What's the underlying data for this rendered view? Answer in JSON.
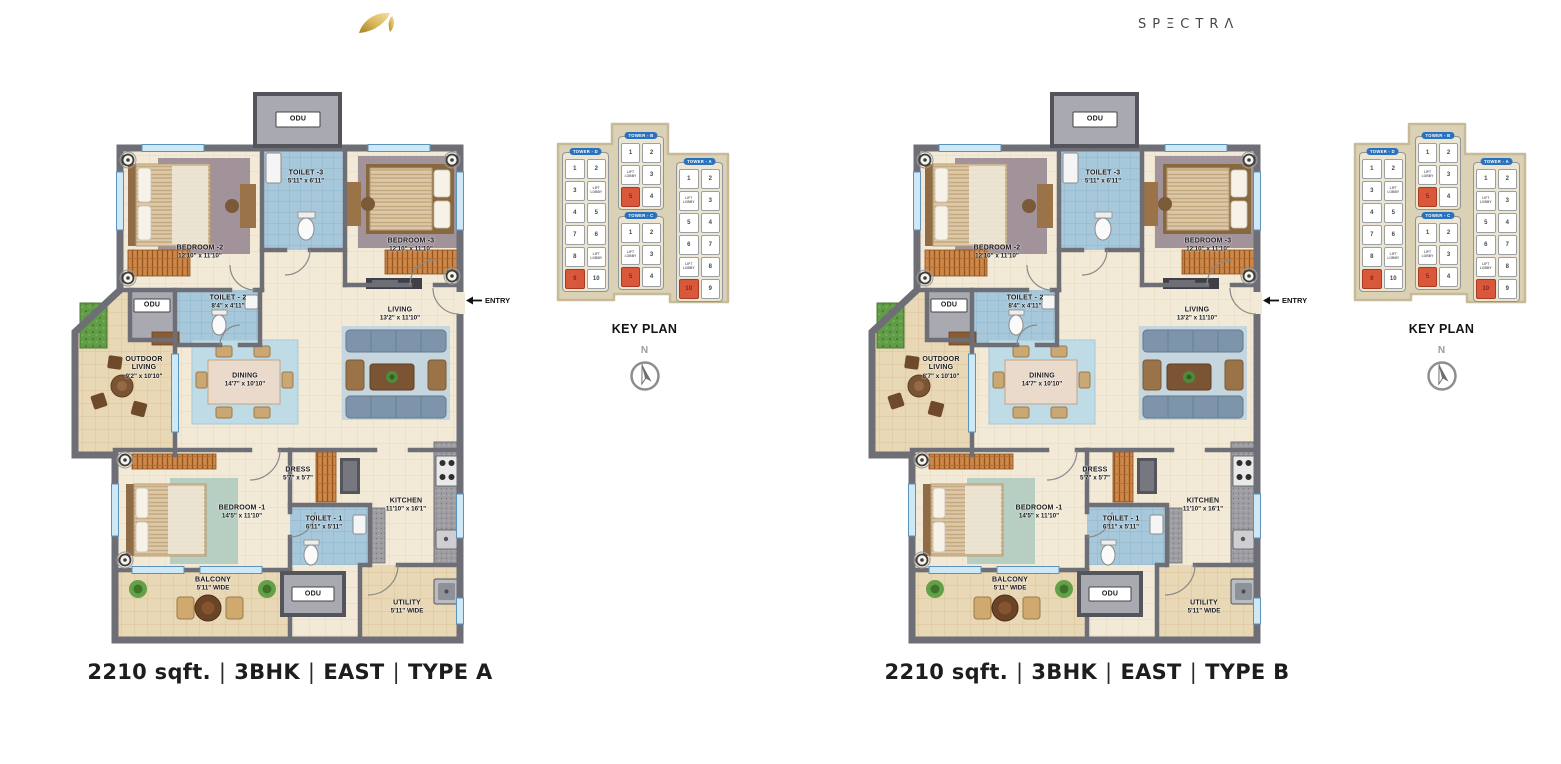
{
  "header": {
    "logo_icon": "gold-leaf",
    "brand": "SPΞCTRΛ"
  },
  "key_plan": {
    "title": "KEY PLAN",
    "north_label": "N",
    "towers": [
      {
        "label": "TOWER - D",
        "cells": [
          {
            "label": "1"
          },
          {
            "label": "2"
          },
          {
            "label": "3"
          },
          {
            "label": "LIFT LOBBY",
            "lift": true
          },
          {
            "label": "4"
          },
          {
            "label": "5"
          },
          {
            "label": "7"
          },
          {
            "label": "6"
          },
          {
            "label": "8"
          },
          {
            "label": "LIFT LOBBY",
            "lift": true
          },
          {
            "label": "9",
            "highlight": true
          },
          {
            "label": "10"
          }
        ]
      },
      {
        "label": "TOWER - B",
        "cells": [
          {
            "label": "1"
          },
          {
            "label": "2"
          },
          {
            "label": "LIFT LOBBY",
            "lift": true
          },
          {
            "label": "3"
          },
          {
            "label": "5",
            "highlight": true
          },
          {
            "label": "4"
          }
        ]
      },
      {
        "label": "TOWER - C",
        "cells": [
          {
            "label": "1"
          },
          {
            "label": "2"
          },
          {
            "label": "LIFT LOBBY",
            "lift": true
          },
          {
            "label": "3"
          },
          {
            "label": "5",
            "highlight": true
          },
          {
            "label": "4"
          }
        ]
      },
      {
        "label": "TOWER - A",
        "cells": [
          {
            "label": "1"
          },
          {
            "label": "2"
          },
          {
            "label": "LIFT LOBBY",
            "lift": true
          },
          {
            "label": "3"
          },
          {
            "label": "5"
          },
          {
            "label": "4"
          },
          {
            "label": "6"
          },
          {
            "label": "7"
          },
          {
            "label": "LIFT LOBBY",
            "lift": true
          },
          {
            "label": "8"
          },
          {
            "label": "10",
            "highlight": true
          },
          {
            "label": "9"
          }
        ]
      }
    ],
    "highlight_color": "#d9583c",
    "tower_pill_color": "#2a72bd"
  },
  "plans": [
    {
      "id": "type-a",
      "caption_parts": [
        "2210 sqft.",
        "3BHK",
        "EAST",
        "TYPE A"
      ],
      "caption_separator": "|",
      "entry_label": "ENTRY",
      "rooms": [
        {
          "id": "odu-top",
          "name": "ODU",
          "dims": "",
          "x": 228,
          "y": 27
        },
        {
          "id": "toilet-3",
          "name": "TOILET -3",
          "dims": "5'11\" x 6'11\"",
          "x": 236,
          "y": 85
        },
        {
          "id": "bedroom-2",
          "name": "BEDROOM -2",
          "dims": "12'10\" x 11'10\"",
          "x": 130,
          "y": 160
        },
        {
          "id": "bedroom-3",
          "name": "BEDROOM -3",
          "dims": "12'10\" x 11'10\"",
          "x": 341,
          "y": 153
        },
        {
          "id": "living",
          "name": "LIVING",
          "dims": "13'2\" x 11'10\"",
          "x": 330,
          "y": 222
        },
        {
          "id": "odu-mid",
          "name": "ODU",
          "dims": "",
          "x": 82,
          "y": 213
        },
        {
          "id": "toilet-2",
          "name": "TOILET - 2",
          "dims": "8'4\" x 4'11\"",
          "x": 158,
          "y": 210
        },
        {
          "id": "outdoor-living",
          "name": "OUTDOOR LIVING",
          "dims": "9'2\" x 10'10\"",
          "x": 74,
          "y": 276,
          "wrap": true
        },
        {
          "id": "dining",
          "name": "DINING",
          "dims": "14'7\" x 10'10\"",
          "x": 175,
          "y": 288
        },
        {
          "id": "dress",
          "name": "DRESS",
          "dims": "5'7\" x 5'7\"",
          "x": 228,
          "y": 382
        },
        {
          "id": "bedroom-1",
          "name": "BEDROOM -1",
          "dims": "14'5\" x 11'10\"",
          "x": 172,
          "y": 420
        },
        {
          "id": "toilet-1",
          "name": "TOILET - 1",
          "dims": "6'11\" x 5'11\"",
          "x": 254,
          "y": 431
        },
        {
          "id": "kitchen",
          "name": "KITCHEN",
          "dims": "11'10\" x 16'1\"",
          "x": 336,
          "y": 413
        },
        {
          "id": "balcony",
          "name": "BALCONY",
          "dims": "5'11\" WIDE",
          "x": 143,
          "y": 492
        },
        {
          "id": "odu-bottom",
          "name": "ODU",
          "dims": "",
          "x": 243,
          "y": 502
        },
        {
          "id": "utility",
          "name": "UTILITY",
          "dims": "5'11\" WIDE",
          "x": 337,
          "y": 515
        }
      ]
    },
    {
      "id": "type-b",
      "caption_parts": [
        "2210 sqft.",
        "3BHK",
        "EAST",
        "TYPE B"
      ],
      "caption_separator": "|",
      "entry_label": "ENTRY",
      "rooms": [
        {
          "id": "odu-top",
          "name": "ODU",
          "dims": "",
          "x": 228,
          "y": 27
        },
        {
          "id": "toilet-3",
          "name": "TOILET -3",
          "dims": "5'11\" x 6'11\"",
          "x": 236,
          "y": 85
        },
        {
          "id": "bedroom-2",
          "name": "BEDROOM -2",
          "dims": "12'10\" x 11'10\"",
          "x": 130,
          "y": 160
        },
        {
          "id": "bedroom-3",
          "name": "BEDROOM -3",
          "dims": "12'10\" x 11'10\"",
          "x": 341,
          "y": 153
        },
        {
          "id": "living",
          "name": "LIVING",
          "dims": "13'2\" x 11'10\"",
          "x": 330,
          "y": 222
        },
        {
          "id": "odu-mid",
          "name": "ODU",
          "dims": "",
          "x": 82,
          "y": 213
        },
        {
          "id": "toilet-2",
          "name": "TOILET - 2",
          "dims": "8'4\" x 4'11\"",
          "x": 158,
          "y": 210
        },
        {
          "id": "outdoor-living",
          "name": "OUTDOOR LIVING",
          "dims": "8'7\" x 10'10\"",
          "x": 74,
          "y": 276,
          "wrap": true
        },
        {
          "id": "dining",
          "name": "DINING",
          "dims": "14'7\" x 10'10\"",
          "x": 175,
          "y": 288
        },
        {
          "id": "dress",
          "name": "DRESS",
          "dims": "5'7\" x 5'7\"",
          "x": 228,
          "y": 382
        },
        {
          "id": "bedroom-1",
          "name": "BEDROOM -1",
          "dims": "14'5\" x 11'10\"",
          "x": 172,
          "y": 420
        },
        {
          "id": "toilet-1",
          "name": "TOILET - 1",
          "dims": "6'11\" x 5'11\"",
          "x": 254,
          "y": 431
        },
        {
          "id": "kitchen",
          "name": "KITCHEN",
          "dims": "11'10\" x 16'1\"",
          "x": 336,
          "y": 413
        },
        {
          "id": "balcony",
          "name": "BALCONY",
          "dims": "5'11\" WIDE",
          "x": 143,
          "y": 492
        },
        {
          "id": "odu-bottom",
          "name": "ODU",
          "dims": "",
          "x": 243,
          "y": 502
        },
        {
          "id": "utility",
          "name": "UTILITY",
          "dims": "5'11\" WIDE",
          "x": 337,
          "y": 515
        }
      ]
    }
  ],
  "colors": {
    "accent_gold": "#c9a23f",
    "keyplan_highlight": "#d9583c",
    "tower_pill": "#2a72bd",
    "toilet_blue": "#a6c8da",
    "floor_cream": "#f2ead7",
    "outdoor_tan": "#e9d8b6"
  }
}
